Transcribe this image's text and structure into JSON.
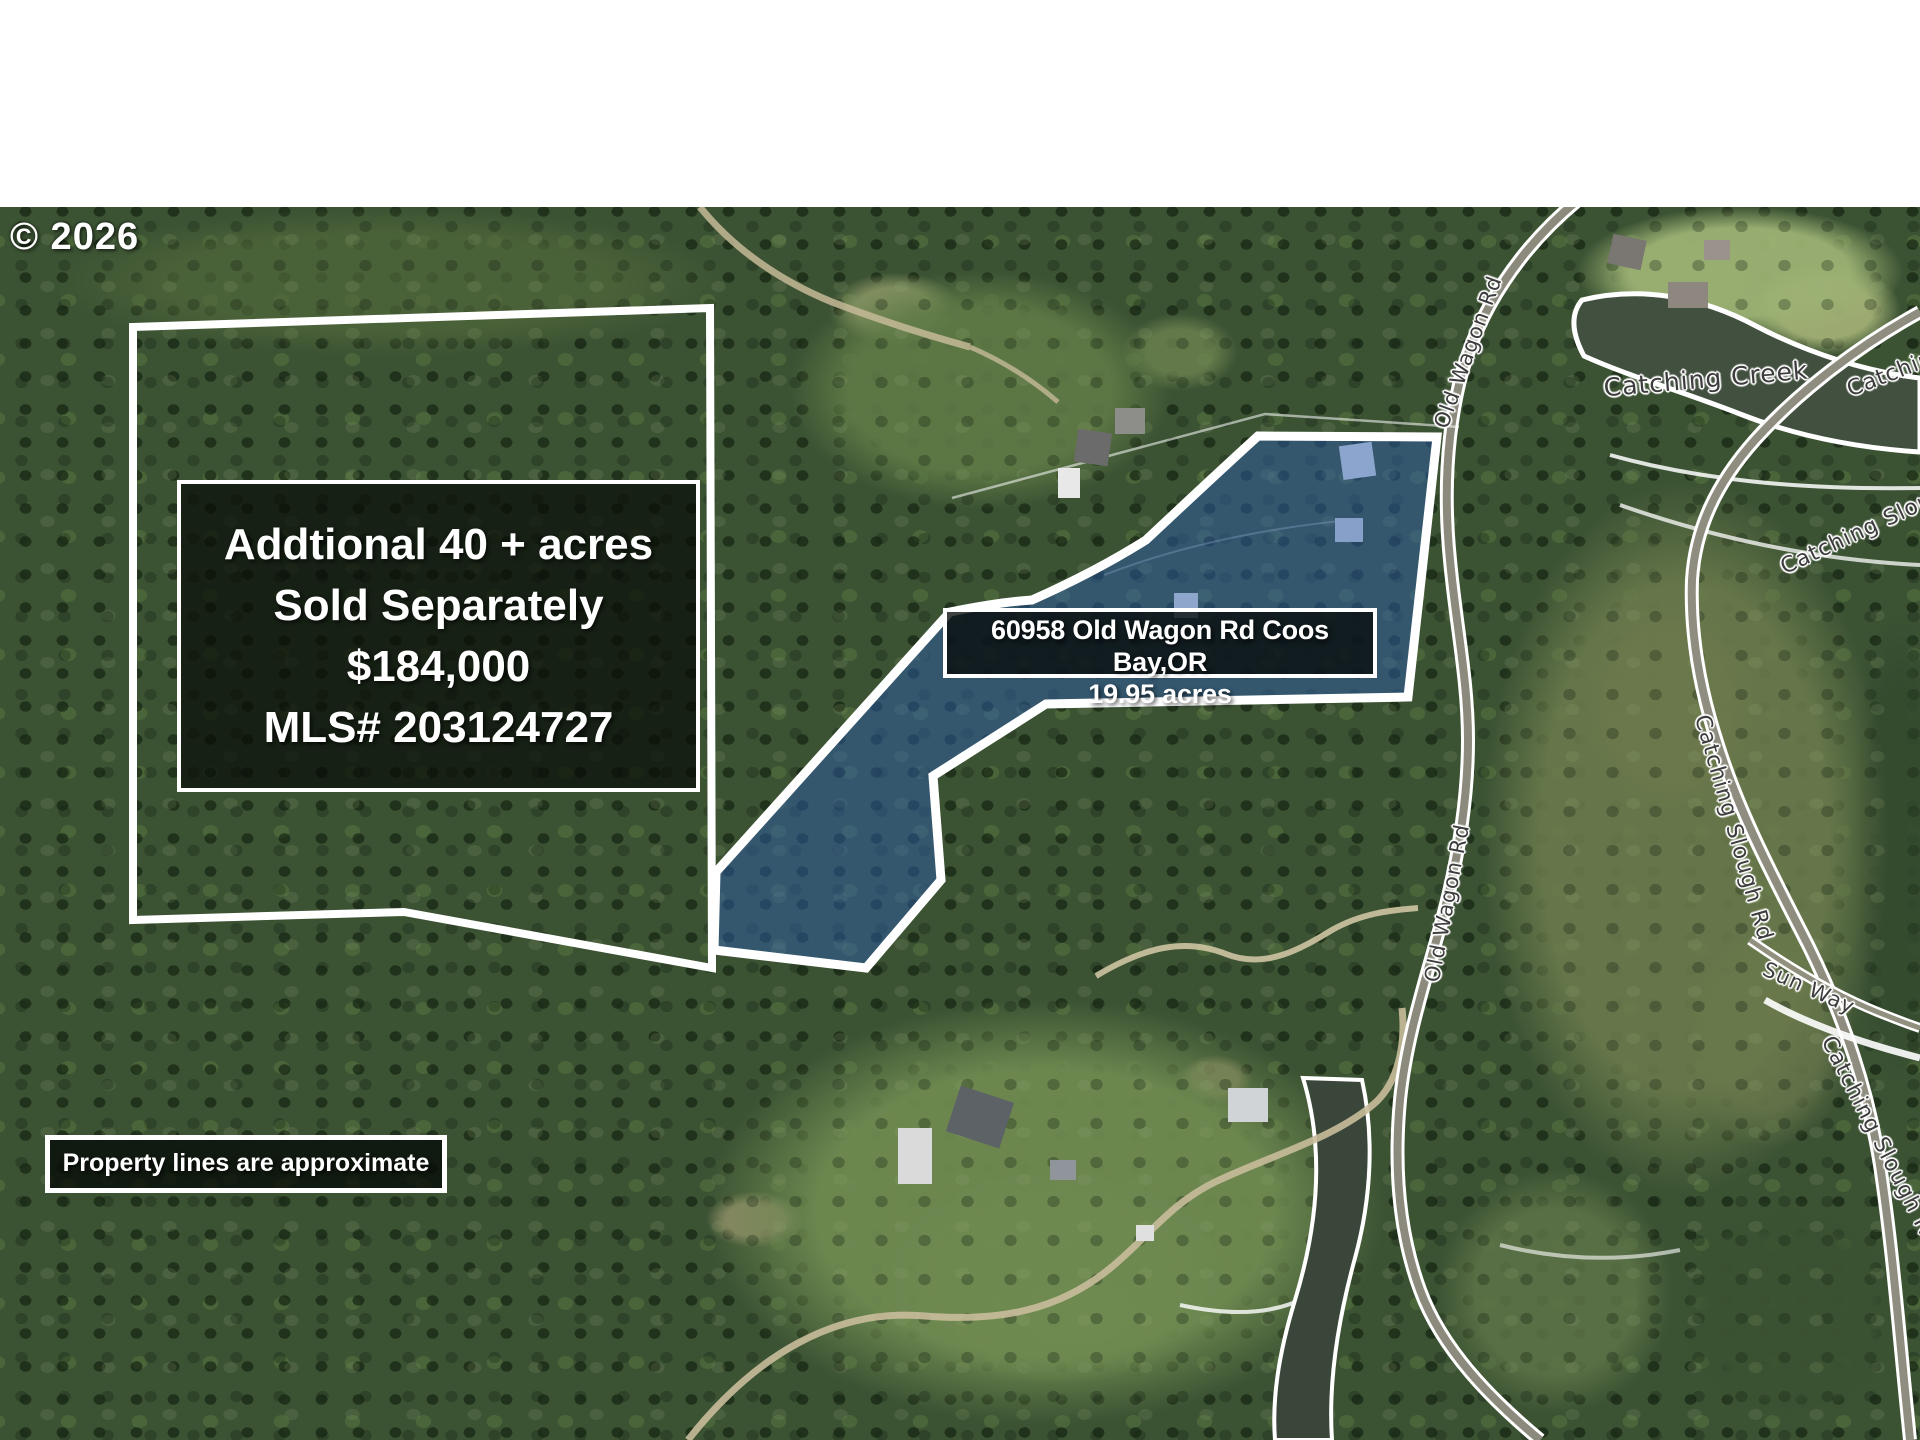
{
  "copyright": "© 2026",
  "info_box": {
    "line1": "Addtional 40 + acres",
    "line2": "Sold Separately",
    "line3": "$184,000",
    "line4": "MLS# 203124727"
  },
  "address_box": {
    "line1": "60958 Old Wagon Rd Coos Bay,OR",
    "line2": "19.95 acres"
  },
  "disclaimer": "Property lines are approximate",
  "road_labels": {
    "old_wagon_rd_top": "Old Wagon Rd",
    "old_wagon_rd_bottom": "Old Wagon Rd",
    "catching_creek": "Catching Creek",
    "catching_slough_rd_top_right": "Catching Slough Rd",
    "catching_slough_rd_upper": "Catching Slough Rd",
    "catching_slough_rd_middle": "Catching Slough Rd",
    "sun_way": "Sun Way",
    "catching_slough_rd_bottom": "Catching Slough Rd"
  },
  "parcels": {
    "highlighted": {
      "address": "60958 Old Wagon Rd Coos Bay,OR",
      "acres": "19.95 acres",
      "fill_rgba": "rgba(45,95,175,0.48)",
      "outline_color": "#ffffff"
    },
    "additional": {
      "description": "Addtional 40 + acres Sold Separately",
      "price": "$184,000",
      "mls": "MLS# 203124727",
      "outline_color": "#ffffff"
    }
  },
  "colors": {
    "water": "#42503f",
    "road_outline": "#ffffff",
    "forest_base": "#3b5233"
  }
}
